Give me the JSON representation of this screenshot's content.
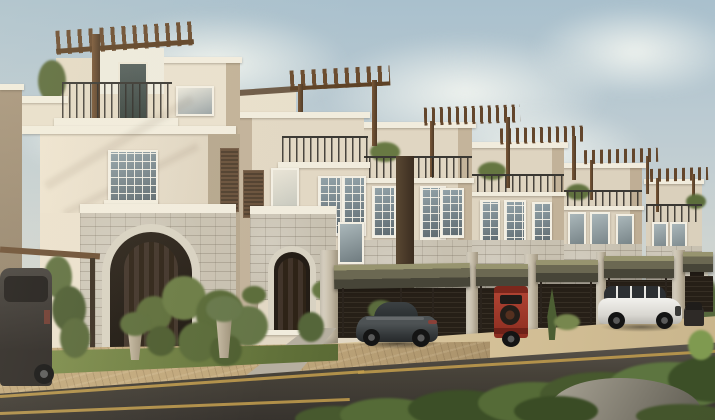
{
  "meta": {
    "title": "Architectural rendering: row of Mediterranean townhouses with rooftop pergolas, stone arched entrances, carports and parked cars along a street",
    "width_px": 715,
    "height_px": 420
  },
  "scene": {
    "sky": {
      "has_clouds": true,
      "color_top": "#a9c0cd",
      "color_horizon": "#ded9cc"
    },
    "buildings": {
      "visible_units": 6,
      "style": "three-storey townhouses, cream stucco, wood rooftop pergolas, iron balcony railings, stone-clad ground floors, arched dark wood entry doors",
      "wall_color": "#e5dbc8",
      "shadow_wall_color": "#b6a78e",
      "trim_color": "#f1ecdd",
      "stone_color": "#c8c1b1",
      "pergola_wood_color": "#6b4c2f",
      "railing_color": "#3a3833",
      "entry_door_color": "#3a2d21"
    },
    "carports": {
      "awning_color": "#6b6852",
      "fence_color": "#261f17",
      "pillar_color": "#cfc8b8"
    },
    "vehicles": [
      {
        "name": "dark-suv",
        "color": "#3a3531",
        "position": "far left under carport awning"
      },
      {
        "name": "sports-coupe",
        "color": "#3a3e3b",
        "position": "center foreground on driveway"
      },
      {
        "name": "red-jeep",
        "color": "#a03828",
        "position": "right of center, rear view with spare tire"
      },
      {
        "name": "white-suv",
        "color": "#e9e8e4",
        "position": "right, in front of carport"
      },
      {
        "name": "small-dark-car",
        "color": "#2e2a27",
        "position": "far right, partly hidden"
      }
    ],
    "landscape": {
      "lawn_color": "#6a7a40",
      "topiary": "multi-ball sculpted shrub on front lawn",
      "hedge_color": "#4e6233",
      "rock_color": "#8b887e",
      "sidewalk_color": "#c1a87c",
      "sand_color": "#d3bf97",
      "road_color": "#44403a",
      "road_line_color": "#c49f4e"
    }
  }
}
